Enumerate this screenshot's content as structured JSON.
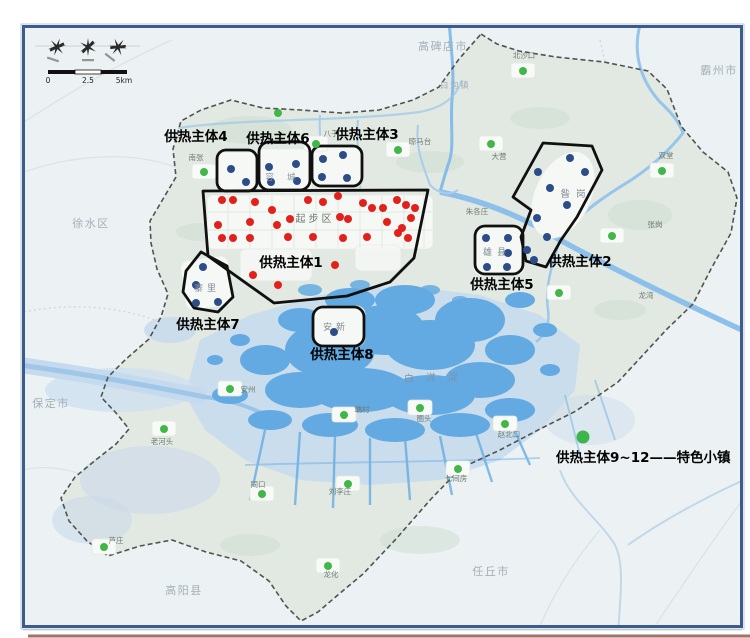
{
  "compass": {
    "scale_labels": [
      "0",
      "2.5",
      "5km"
    ]
  },
  "legend": {
    "text": "供热主体9~12——特色小镇",
    "dot_color": "#3cb54a"
  },
  "colors": {
    "outside_land": "#ecf2f3",
    "region_fill": "#e1e9e2",
    "lake": "#63aae2",
    "marsh": "#c6daee",
    "river": "#8cc0ea",
    "red_dot": "#e3211c",
    "blue_dot": "#2c4d87",
    "green_dot": "#43b649",
    "zone_outline": "#101010",
    "boundary": "#4f5451",
    "frame": "#3c5c8c"
  },
  "map": {
    "lake_label": {
      "text": "白洋淀",
      "x": 404,
      "y": 382
    },
    "cities": [
      {
        "name": "高碑店市",
        "x": 443,
        "y": 50,
        "size": 11
      },
      {
        "name": "霸州市",
        "x": 719,
        "y": 74,
        "size": 11
      },
      {
        "name": "徐水区",
        "x": 91,
        "y": 227,
        "size": 11
      },
      {
        "name": "保定市",
        "x": 51,
        "y": 407,
        "size": 11
      },
      {
        "name": "高阳县",
        "x": 184,
        "y": 594,
        "size": 11
      },
      {
        "name": "任丘市",
        "x": 491,
        "y": 575,
        "size": 11
      },
      {
        "name": "白沟镇",
        "x": 455,
        "y": 88,
        "size": 8.5
      }
    ],
    "area_labels": [
      {
        "text": "起步区",
        "x": 315,
        "y": 222,
        "size": 10,
        "color": "#66766a",
        "ls": 3
      },
      {
        "text": "容城",
        "x": 287,
        "y": 180,
        "size": 8.5,
        "color": "#8a94a0",
        "ls": 13
      },
      {
        "text": "寨里",
        "x": 207,
        "y": 291,
        "size": 9,
        "color": "#7f8c98",
        "ls": 4
      },
      {
        "text": "安新",
        "x": 336,
        "y": 330,
        "size": 9,
        "color": "#7f8c98",
        "ls": 4
      },
      {
        "text": "雄县",
        "x": 497,
        "y": 255,
        "size": 9,
        "color": "#7f8c98",
        "ls": 5
      },
      {
        "text": "昝岗",
        "x": 576,
        "y": 197,
        "size": 9.5,
        "color": "#7f8c98",
        "ls": 6
      }
    ],
    "towns": [
      {
        "name": "北沙口",
        "label": [
          524,
          58
        ],
        "dot": [
          523,
          71
        ]
      },
      {
        "name": "晾马台",
        "label": [
          420,
          144
        ],
        "dot": [
          398,
          150
        ]
      },
      {
        "name": "八于",
        "label": [
          331,
          136
        ],
        "dot": [
          316,
          144
        ]
      },
      {
        "name": "南张",
        "label": [
          196,
          160
        ],
        "dot": [
          204,
          172
        ]
      },
      {
        "name": "大营",
        "label": [
          499,
          159
        ],
        "dot": [
          491,
          144
        ]
      },
      {
        "name": "双堂",
        "label": [
          666,
          158
        ],
        "dot": [
          662,
          171
        ]
      },
      {
        "name": "张岗",
        "label": [
          655,
          227
        ],
        "dot": [
          612,
          236
        ]
      },
      {
        "name": "龙湾",
        "label": [
          646,
          298
        ],
        "dot": [
          559,
          293
        ]
      },
      {
        "name": "朱各庄",
        "label": [
          477,
          214
        ],
        "dot": null
      },
      {
        "name": "老河头",
        "label": [
          162,
          444
        ],
        "dot": [
          164,
          429
        ]
      },
      {
        "name": "安州",
        "label": [
          248,
          392
        ],
        "dot": [
          230,
          389
        ]
      },
      {
        "name": "同口",
        "label": [
          258,
          487
        ],
        "dot": [
          262,
          494
        ]
      },
      {
        "name": "端村",
        "label": [
          362,
          412
        ],
        "dot": [
          344,
          415
        ]
      },
      {
        "name": "刘李庄",
        "label": [
          340,
          494
        ],
        "dot": [
          348,
          484
        ]
      },
      {
        "name": "圈头",
        "label": [
          424,
          421
        ],
        "dot": [
          420,
          408
        ]
      },
      {
        "name": "赵北口",
        "label": [
          509,
          437
        ],
        "dot": [
          505,
          424
        ]
      },
      {
        "name": "七间房",
        "label": [
          456,
          481
        ],
        "dot": [
          458,
          469
        ]
      },
      {
        "name": "龙化",
        "label": [
          331,
          577
        ],
        "dot": [
          328,
          566
        ]
      },
      {
        "name": "芦庄",
        "label": [
          116,
          543
        ],
        "dot": [
          104,
          547
        ]
      }
    ],
    "extra_green_dots": [
      [
        278,
        113
      ]
    ],
    "zones": [
      {
        "id": 1,
        "label": "供热主体1",
        "label_x": 291,
        "label_y": 267,
        "dot_color": "red",
        "shape": {
          "type": "polygon",
          "points": "203,191 428,190 414,258 390,282 347,296 274,303 208,256"
        },
        "dots": [
          [
            222,
            200
          ],
          [
            233,
            200
          ],
          [
            255,
            202
          ],
          [
            272,
            210
          ],
          [
            290,
            219
          ],
          [
            308,
            200
          ],
          [
            323,
            202
          ],
          [
            338,
            196
          ],
          [
            363,
            203
          ],
          [
            372,
            208
          ],
          [
            383,
            208
          ],
          [
            397,
            200
          ],
          [
            406,
            205
          ],
          [
            415,
            208
          ],
          [
            218,
            225
          ],
          [
            250,
            222
          ],
          [
            277,
            225
          ],
          [
            340,
            217
          ],
          [
            348,
            219
          ],
          [
            387,
            222
          ],
          [
            402,
            228
          ],
          [
            411,
            218
          ],
          [
            398,
            233
          ],
          [
            222,
            238
          ],
          [
            233,
            238
          ],
          [
            250,
            238
          ],
          [
            288,
            237
          ],
          [
            313,
            237
          ],
          [
            343,
            238
          ],
          [
            367,
            237
          ],
          [
            408,
            238
          ],
          [
            335,
            265
          ],
          [
            253,
            275
          ],
          [
            278,
            285
          ]
        ]
      },
      {
        "id": 2,
        "label": "供热主体2",
        "label_x": 580,
        "label_y": 266,
        "dot_color": "blue",
        "shape": {
          "type": "polygon",
          "points": "543,143 592,146 602,170 577,217 561,240 546,267 526,261 521,237 531,210 513,197"
        },
        "dots": [
          [
            570,
            158
          ],
          [
            538,
            172
          ],
          [
            585,
            172
          ],
          [
            550,
            188
          ],
          [
            567,
            205
          ],
          [
            537,
            218
          ],
          [
            547,
            237
          ],
          [
            527,
            250
          ],
          [
            534,
            260
          ]
        ]
      },
      {
        "id": 3,
        "label": "供热主体3",
        "label_x": 367,
        "label_y": 139,
        "dot_color": "blue",
        "shape": {
          "type": "rect",
          "x": 312,
          "y": 146,
          "w": 50,
          "h": 40,
          "r": 9
        },
        "dots": [
          [
            323,
            159
          ],
          [
            343,
            155
          ],
          [
            322,
            177
          ],
          [
            347,
            178
          ]
        ]
      },
      {
        "id": 4,
        "label": "供热主体4",
        "label_x": 196,
        "label_y": 141,
        "dot_color": "blue",
        "shape": {
          "type": "rect",
          "x": 217,
          "y": 150,
          "w": 40,
          "h": 41,
          "r": 9
        },
        "dots": [
          [
            231,
            169
          ],
          [
            246,
            182
          ]
        ]
      },
      {
        "id": 5,
        "label": "供热主体5",
        "label_x": 502,
        "label_y": 289,
        "dot_color": "blue",
        "shape": {
          "type": "rect",
          "x": 475,
          "y": 226,
          "w": 48,
          "h": 48,
          "r": 10
        },
        "dots": [
          [
            486,
            238
          ],
          [
            508,
            238
          ],
          [
            508,
            253
          ],
          [
            487,
            267
          ],
          [
            507,
            267
          ]
        ]
      },
      {
        "id": 6,
        "label": "供热主体6",
        "label_x": 278,
        "label_y": 143,
        "dot_color": "blue",
        "shape": {
          "type": "rect",
          "x": 259,
          "y": 142,
          "w": 51,
          "h": 48,
          "r": 10
        },
        "dots": [
          [
            269,
            167
          ],
          [
            296,
            164
          ],
          [
            271,
            182
          ],
          [
            297,
            181
          ]
        ]
      },
      {
        "id": 7,
        "label": "供热主体7",
        "label_x": 208,
        "label_y": 329,
        "dot_color": "blue",
        "shape": {
          "type": "polygon",
          "points": "201,252 186,271 183,292 194,308 218,312 233,297 227,266"
        },
        "dots": [
          [
            203,
            267
          ],
          [
            196,
            285
          ],
          [
            196,
            303
          ],
          [
            218,
            302
          ]
        ]
      },
      {
        "id": 8,
        "label": "供热主体8",
        "label_x": 342,
        "label_y": 359,
        "dot_color": "blue",
        "shape": {
          "type": "rect",
          "x": 313,
          "y": 307,
          "w": 51,
          "h": 39,
          "r": 10
        },
        "dots": [
          [
            334,
            332
          ]
        ]
      }
    ]
  }
}
